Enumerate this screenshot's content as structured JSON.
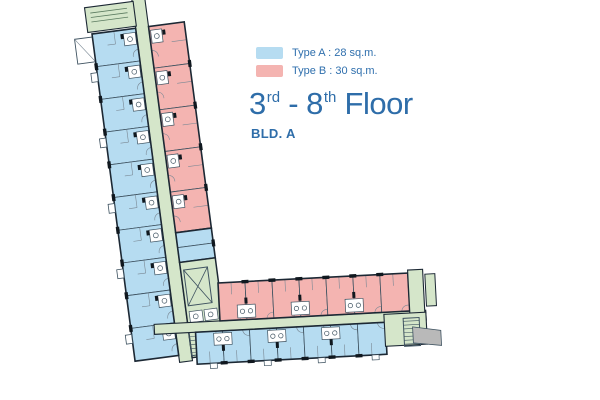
{
  "legend": {
    "items": [
      {
        "type": "A",
        "label": "Type A : 28 sq.m."
      },
      {
        "type": "B",
        "label": "Type B : 30 sq.m."
      }
    ]
  },
  "title": {
    "from_number": "3",
    "from_suffix": "rd",
    "middle": " - 8",
    "to_suffix": "th",
    "tail": " Floor"
  },
  "building_label": "BLD. A",
  "colors": {
    "type_a_blue": "#b6dcf1",
    "type_b_pink": "#f4b4b1",
    "corridor_green": "#d5e6ca",
    "outline_dark": "#1c2834",
    "wall_mid": "#3e5260",
    "detail_light": "#7a8894",
    "tick_black": "#10181f",
    "service_gray": "#b9b9b9",
    "text_blue": "#2e6da9"
  }
}
